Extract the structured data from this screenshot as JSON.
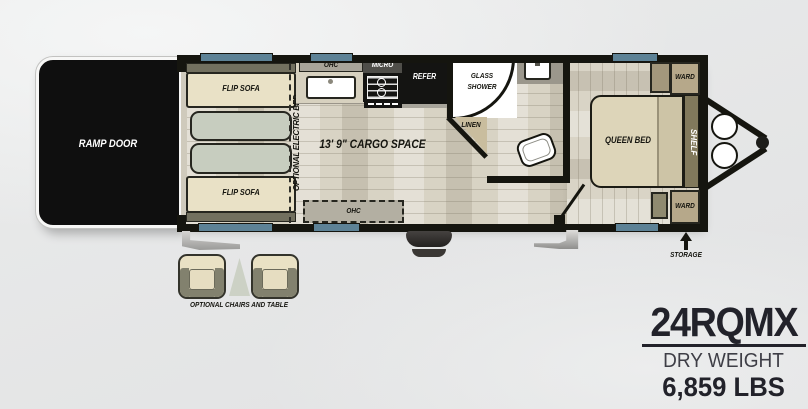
{
  "floorplan": {
    "ramp_door_label": "RAMP DOOR",
    "sofas": {
      "top": "FLIP SOFA",
      "bottom": "FLIP SOFA"
    },
    "optional_electric_bed_label": "OPTIONAL ELECTRIC BED",
    "kitchen": {
      "ohc_top": "OHC",
      "micro": "MICRO",
      "refer": "REFER",
      "ohc_bottom": "OHC"
    },
    "bath": {
      "shower": "GLASS SHOWER",
      "linen": "LINEN"
    },
    "cargo_label": "13' 9\" CARGO SPACE",
    "bedroom": {
      "bed": "QUEEN BED",
      "shelf": "SHELF",
      "ward_top": "WARD",
      "ward_bottom": "WARD",
      "storage": "STORAGE"
    },
    "options_label": "OPTIONAL CHAIRS AND TABLE"
  },
  "title_block": {
    "model": "24RQMX",
    "weight_label": "DRY WEIGHT",
    "weight_value": "6,859 LBS"
  },
  "colors": {
    "wall": "#15150f",
    "window_blue": "#5d8296",
    "floor_base": "#d8d3c4",
    "sofa_beige": "#e9e1c6",
    "cushion_sage": "#c7cdbf",
    "ward_tan": "#b6a88a",
    "shelf_olive": "#81795c",
    "ramp_black": "#0f0f0f",
    "accent_dark": "#22222a"
  }
}
